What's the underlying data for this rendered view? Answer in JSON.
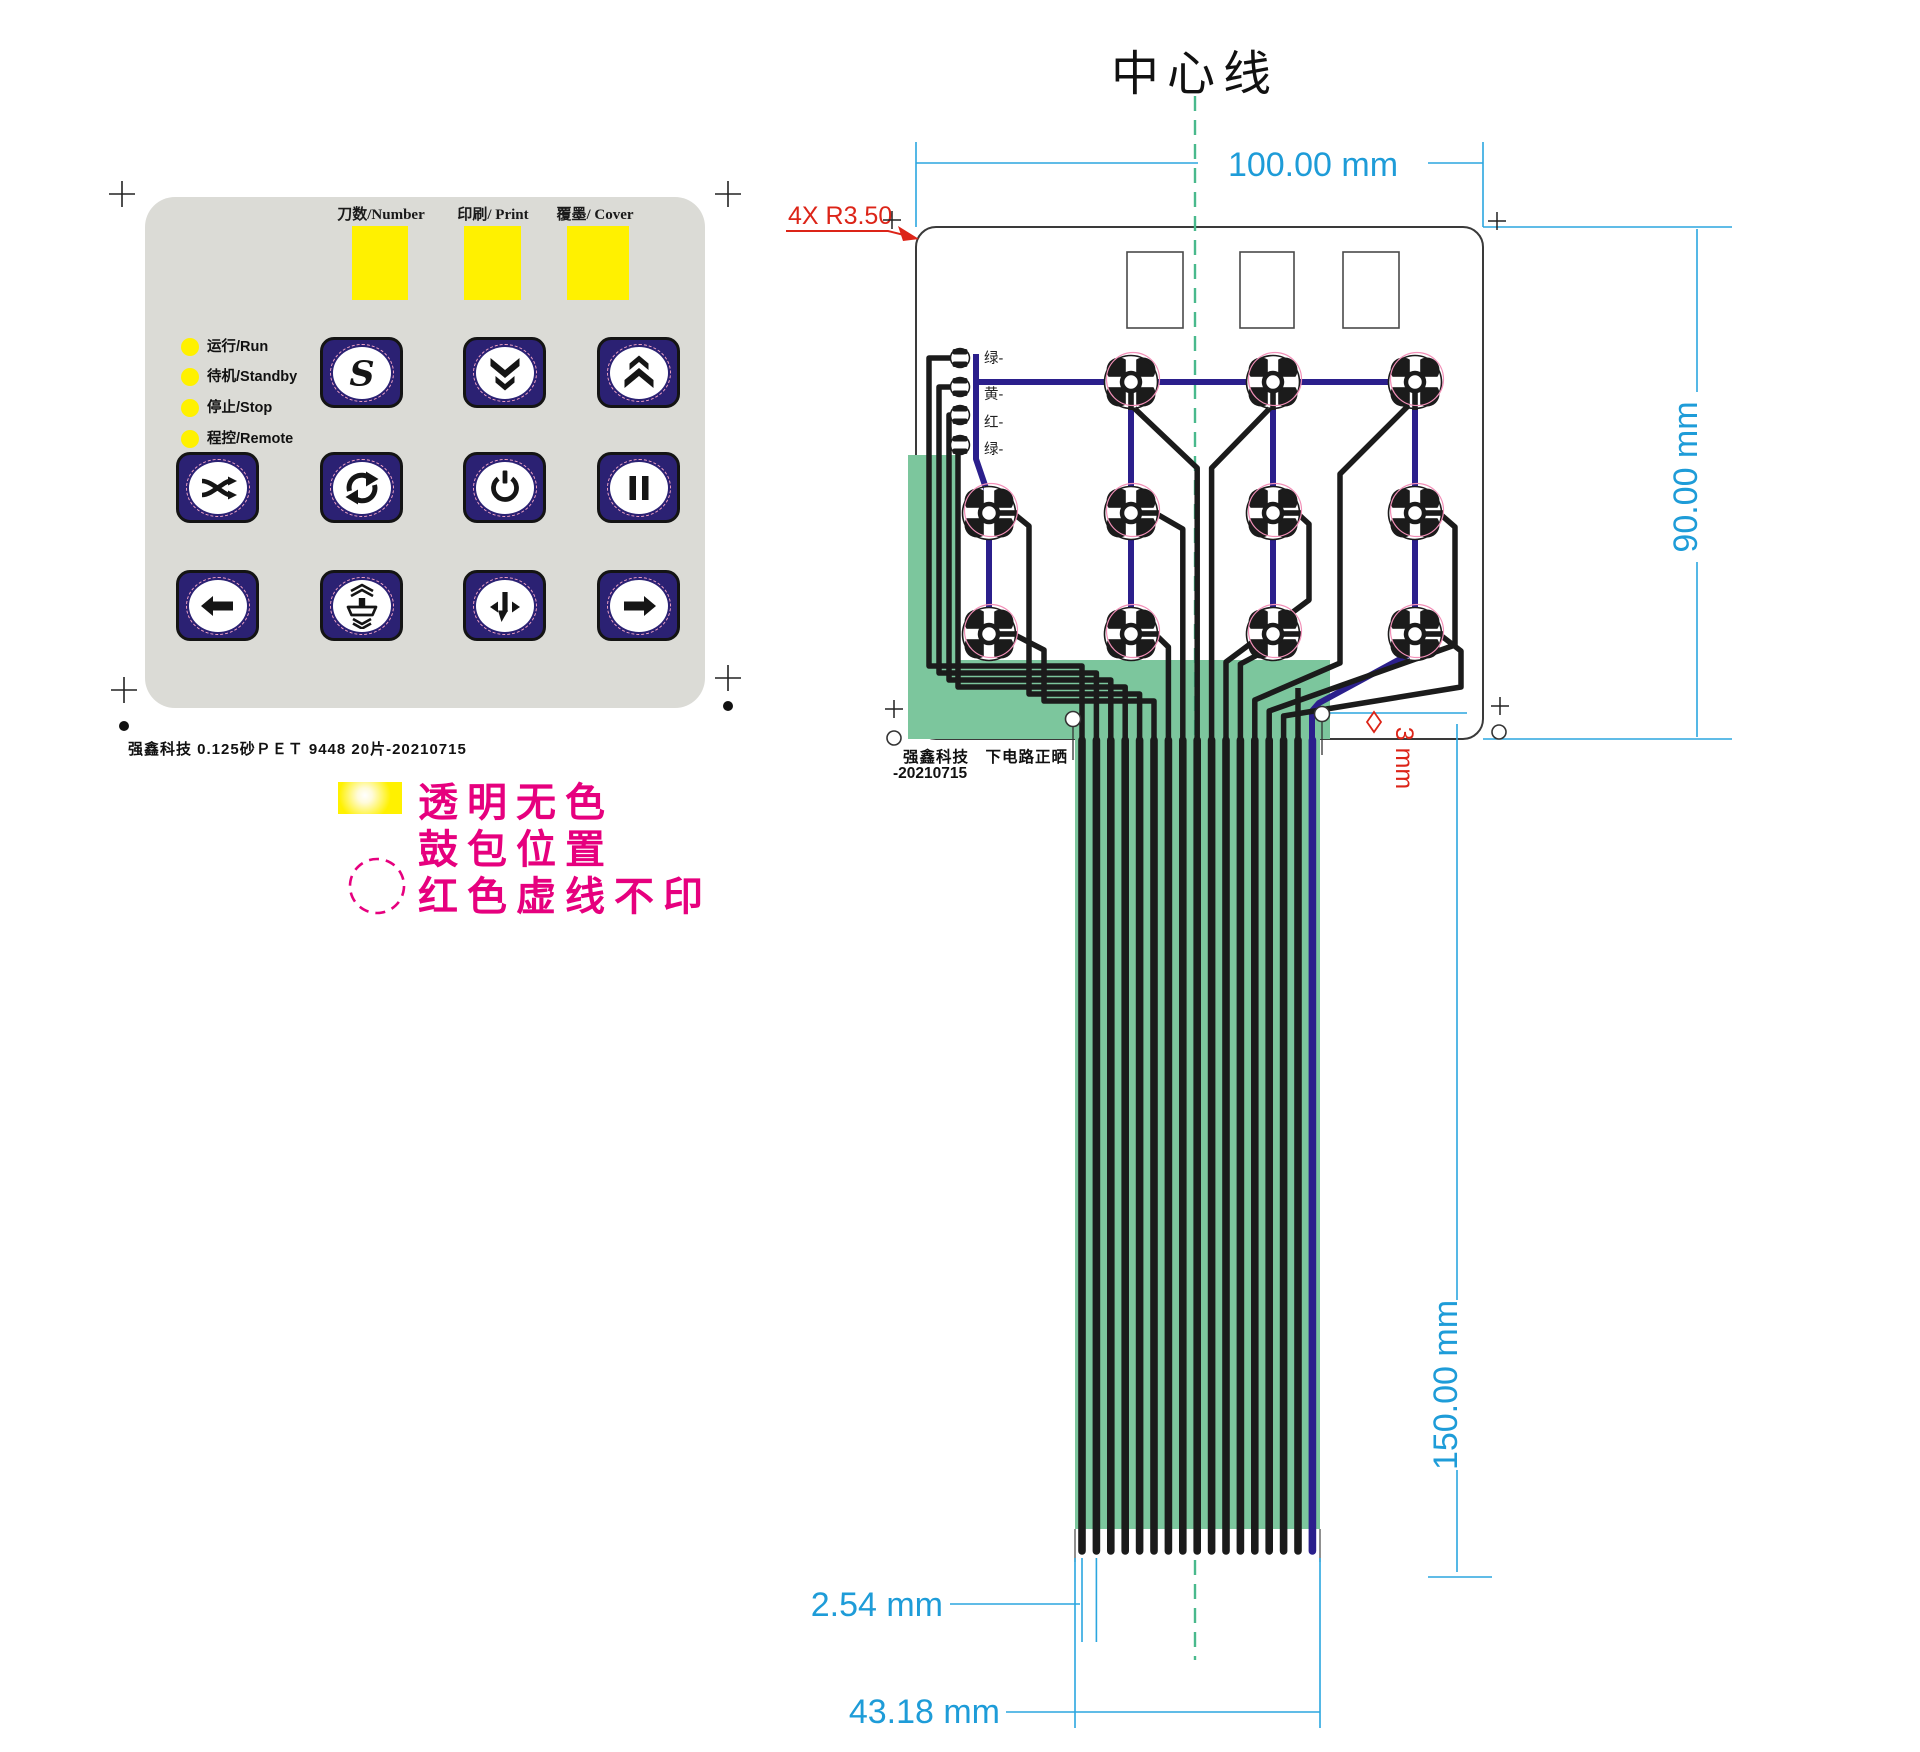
{
  "keypad": {
    "window_labels": [
      "刀数/Number",
      "印刷/ Print",
      "覆墨/ Cover"
    ],
    "led_labels": [
      "运行/Run",
      "待机/Standby",
      "停止/Stop",
      "程控/Remote"
    ],
    "s_label": "S",
    "button_icons": [
      "s-button",
      "chevron-double-down",
      "chevron-double-up",
      "shuffle",
      "cycle",
      "power",
      "pause",
      "arrow-left",
      "press-platen",
      "paper-feed",
      "arrow-right"
    ],
    "caption": "强鑫科技  0.125砂ＰＥＴ  9448  20片-20210715"
  },
  "legend": {
    "line1": "透明无色",
    "line2": "鼓包位置",
    "line3": "红色虚线不印"
  },
  "circuit": {
    "title": "中心线",
    "corner_radius_note": "4X R3.50",
    "led_labels": [
      "绿-",
      "黄-",
      "红-",
      "绿-"
    ],
    "caption_line1": "强鑫科技　下电路正晒",
    "caption_line2": "-20210715",
    "hole_dim": "3 mm",
    "pin_count": 17,
    "dims": {
      "width": "100.00 mm",
      "height": "90.00 mm",
      "tail_length": "150.00 mm",
      "pin_pitch": "2.54 mm",
      "tail_width": "43.18 mm"
    }
  },
  "colors": {
    "panel_gray": "#DBDBD6",
    "button_navy": "#2B2173",
    "trace_black": "#1b1b1b",
    "trace_blue": "#2B1F8C",
    "flex_green": "#7CC69D",
    "dim_blue": "#1E9CD8",
    "dim_line_blue": "#2BA6DF",
    "annotation_red": "#DC2418",
    "legend_magenta": "#E6007E",
    "window_yellow": "#FFF100",
    "centerline_green": "#49B98C",
    "pad_pink": "#F290B8"
  }
}
